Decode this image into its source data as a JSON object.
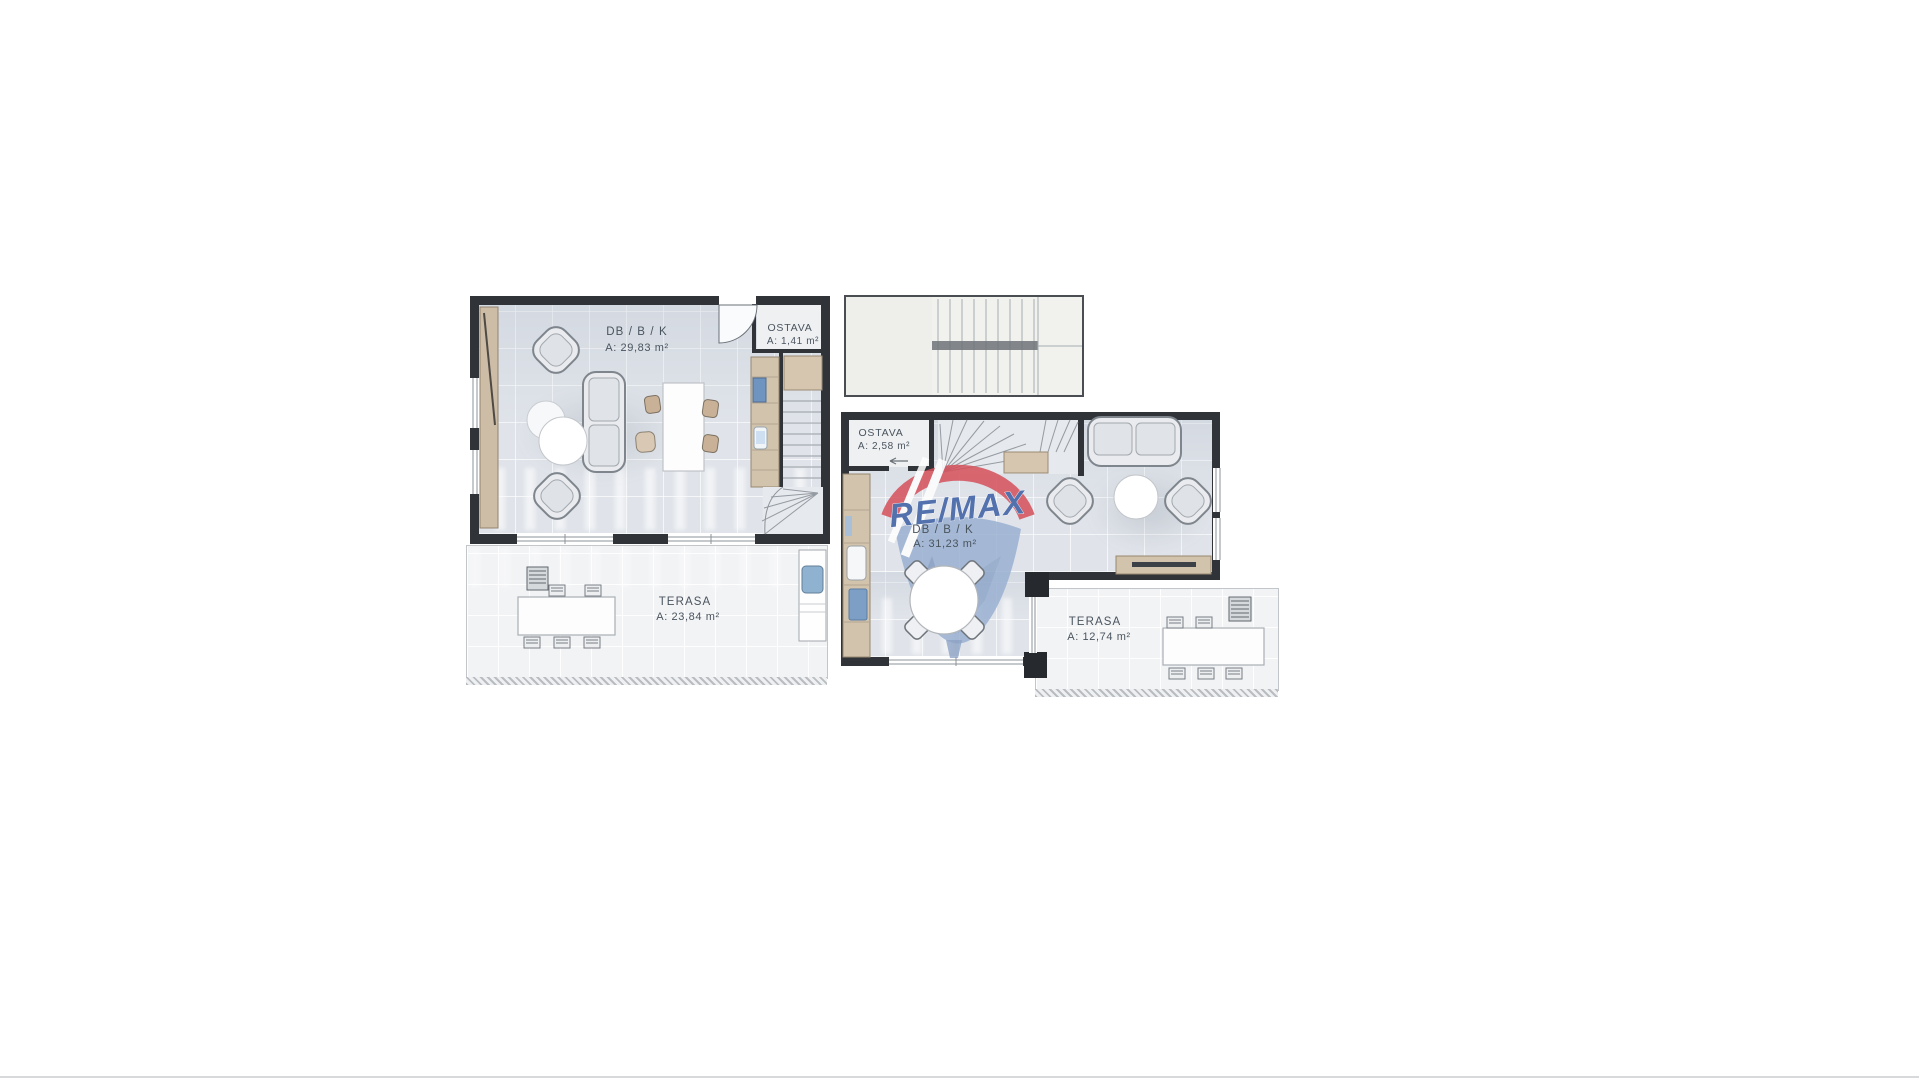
{
  "watermark": {
    "brand": "RE/MAX",
    "red": "#d5505a",
    "blue_text": "#3a5da3",
    "balloon_blue": "#9ab1d2"
  },
  "units": {
    "left": {
      "living": {
        "name": "DB / B / K",
        "area": "A: 29,83 m²"
      },
      "storage": {
        "name": "OSTAVA",
        "area": "A: 1,41 m²"
      },
      "terrace": {
        "name": "TERASA",
        "area": "A: 23,84 m²"
      }
    },
    "right": {
      "living": {
        "name": "DB / B / K",
        "area": "A: 31,23 m²"
      },
      "storage": {
        "name": "OSTAVA",
        "area": "A: 2,58 m²"
      },
      "terrace": {
        "name": "TERASA",
        "area": "A: 12,74 m²"
      }
    }
  },
  "colors": {
    "wall": "#303439",
    "wood": "#d2c3ad",
    "room_floor": "#e0e4ea",
    "terrace_floor": "#f2f3f5",
    "appliance_blue": "#7d9fc6",
    "label_text": "#4a545e"
  }
}
